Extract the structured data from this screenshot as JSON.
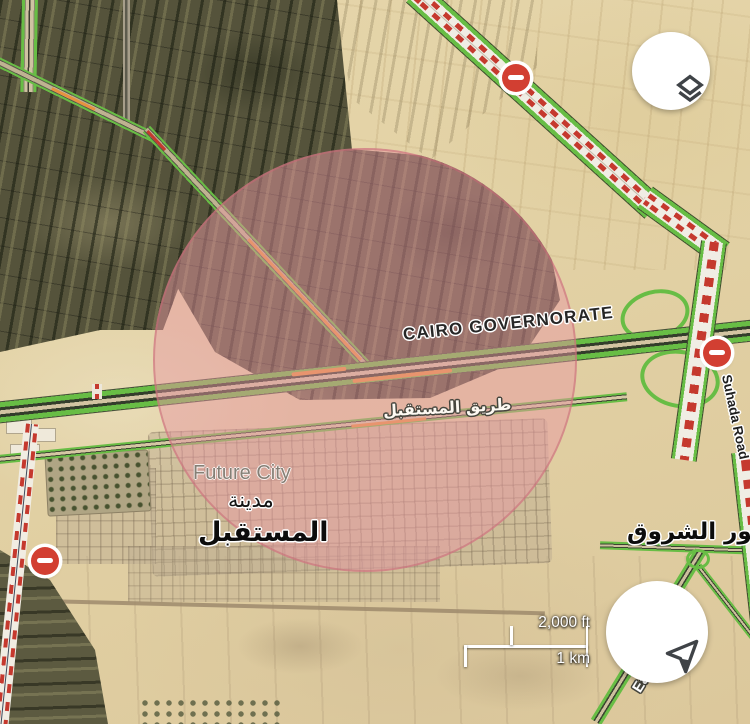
{
  "app": {
    "view_name": "satellite-map-with-traffic"
  },
  "labels": {
    "governorate": "CAIRO GOVERNORATE",
    "future_city": "Future City",
    "future_city_arabic_line1": "مدينة",
    "future_city_arabic_line2": "المستقبل",
    "future_road_arabic": "طريق المستقبل",
    "nour_el_shorouk_arabic": "نور الشروق",
    "suhada_road": "Suhada Road",
    "east_road_partial": "Ea"
  },
  "scale_bar": {
    "imperial": "2,000 ft",
    "metric": "1 km"
  },
  "traffic": {
    "road_closed_icon_count": 3,
    "colors": {
      "open_green": "#68bd45",
      "slow_orange": "#e8923f",
      "closed_red_dash": "#c5392e"
    }
  },
  "overlay": {
    "selection_circle_color": "rgba(231,150,164,0.48)"
  },
  "controls": {
    "layers_button_icon": "layers-icon",
    "navigation_button_icon": "navigation-arrow-icon"
  }
}
